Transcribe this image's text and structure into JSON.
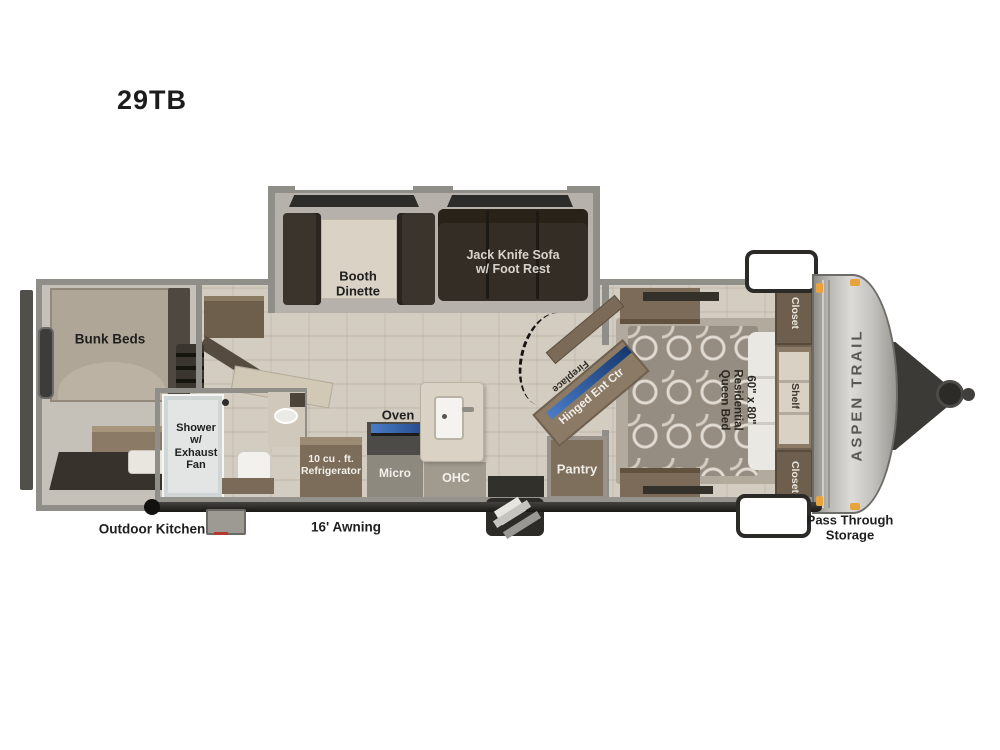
{
  "title": "29TB",
  "labels": {
    "bunk_beds": "Bunk Beds",
    "booth_dinette": "Booth\nDinette",
    "jack_knife_sofa": "Jack Knife Sofa\nw/ Foot Rest",
    "shower": "Shower\nw/\nExhaust\nFan",
    "oven": "Oven",
    "refrigerator": "10 cu . ft.\nRefrigerator",
    "micro": "Micro",
    "ohc": "OHC",
    "pantry": "Pantry",
    "fireplace": "Fireplace",
    "hinged_ent_ctr": "Hinged Ent Ctr",
    "queen_bed": "60\" x 80\"\nResidential\nQueen Bed",
    "closet_top": "Closet",
    "shelf": "Shelf",
    "closet_bottom": "Closet",
    "brand": "ASPEN TRAIL",
    "outdoor_kitchen": "Outdoor Kitchen",
    "awning": "16' Awning",
    "pass_through_storage": "Pass Through\nStorage"
  },
  "colors": {
    "wall_gray": "#8f8e88",
    "floor_beige": "#d3ccc0",
    "slide_floor": "#b6b2ab",
    "cabinet_wood": "#7c6c59",
    "cushion_dark": "#332d26",
    "tv_blue": "#3f6fbe",
    "front_cap_silver": "#c9c7c3",
    "marker_light_orange": "#e8a33c",
    "awning_dark": "#23221f",
    "shower_pan": "#e2e5e4"
  }
}
